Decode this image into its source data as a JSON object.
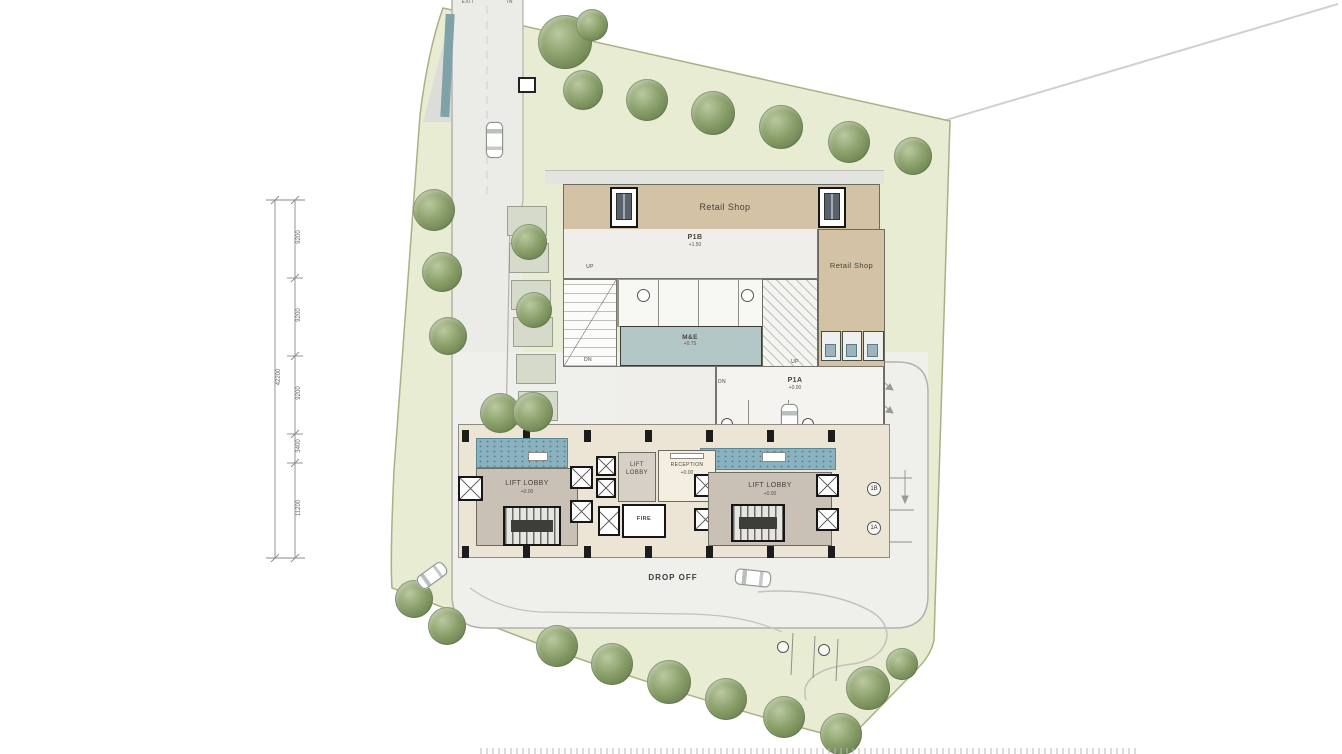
{
  "plan_type": "architectural ground floor site plan",
  "labels": {
    "retail_shop_top": "Retail Shop",
    "retail_shop_right": "Retail Shop",
    "p1b": "P1B",
    "p1b_level": "+1.50",
    "p1a": "P1A",
    "p1a_level": "+0.00",
    "me_room": "M&E",
    "me_level": "+0.75",
    "lobby_left": "LIFT LOBBY",
    "lobby_left_level": "+0.00",
    "lobby_mid_line1": "LIFT",
    "lobby_mid_line2": "LOBBY",
    "lobby_right": "LIFT LOBBY",
    "lobby_right_level": "+0.00",
    "reception": "RECEPTION",
    "reception_level": "+0.00",
    "fire": "FIRE",
    "drop_off": "DROP OFF",
    "up_ramp": "UP",
    "dn_ramp_left": "DN",
    "dn_ramp_mid": "DN",
    "up_stair": "UP",
    "exit": "EXIT",
    "in_gate": "IN"
  },
  "stalls": {
    "right_top": "1B",
    "right_bottom": "1A"
  },
  "dimensions": {
    "total": "42200",
    "segments": [
      "9200",
      "9200",
      "9200",
      "3400",
      "11200"
    ]
  },
  "colors": {
    "site_green": "#e8ecd3",
    "road_gray": "#ebebe8",
    "retail_tan": "#d3c2a3",
    "parking_floor": "#efeeea",
    "lobby_taupe": "#c9c0b6",
    "water_blue": "#8ab2be",
    "me_blue": "#b4c7c7",
    "tree_green": "#7d9158",
    "wall_black": "#161616",
    "ground_cream": "#ece5d5"
  }
}
